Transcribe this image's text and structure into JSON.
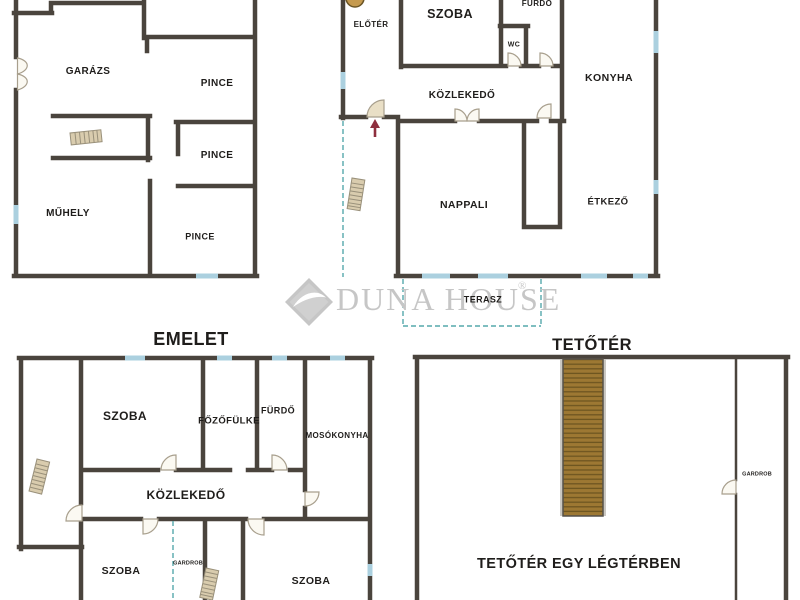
{
  "document_type": "floor-plan-sheet",
  "labels": {
    "garazs": "GARÁZS",
    "pince_1": "PINCE",
    "pince_2": "PINCE",
    "pince_3": "PINCE",
    "muhely": "MŰHELY",
    "eloter": "ELŐTÉR",
    "szoba_fsz": "SZOBA",
    "furdo_fsz": "FÜRDŐ",
    "wc": "WC",
    "konyha": "KONYHA",
    "kozlekedo_fsz": "KÖZLEKEDŐ",
    "nappali": "NAPPALI",
    "etkezo": "ÉTKEZŐ",
    "terasz": "TERASZ",
    "emelet_title": "EMELET",
    "szoba_em1": "SZOBA",
    "fozofulke": "FŐZŐFÜLKE",
    "furdo_em": "FÜRDŐ",
    "mosokonyha": "MOSÓKONYHA",
    "kozlekedo_em": "KÖZLEKEDŐ",
    "szoba_em2": "SZOBA",
    "gardrob_em": "GARDROB",
    "szoba_em3": "SZOBA",
    "tetoter_title": "TETŐTÉR",
    "gardrob_tet": "GARDROB",
    "tetoter_note": "TETŐTÉR EGY LÉGTÉRBEN",
    "watermark_brand": "DUNA HOUSE",
    "registered": "®"
  },
  "colors": {
    "wall": "#4a443d",
    "window": "#abd0df",
    "dash": "#55a8ac",
    "stair_tan": "#d9ccae",
    "stair_line": "#99907a",
    "stairs_brown": "#9d7833",
    "stairs_brown_line": "#6e5520",
    "arrow": "#8e2f3e",
    "door_fill": "#fbf9f2",
    "door_stroke": "#a89f8d",
    "door_tan": "#e9dfc6",
    "stove": "#c59a4f",
    "watermark": "#c6c6c6",
    "text": "#1f1d1b"
  }
}
